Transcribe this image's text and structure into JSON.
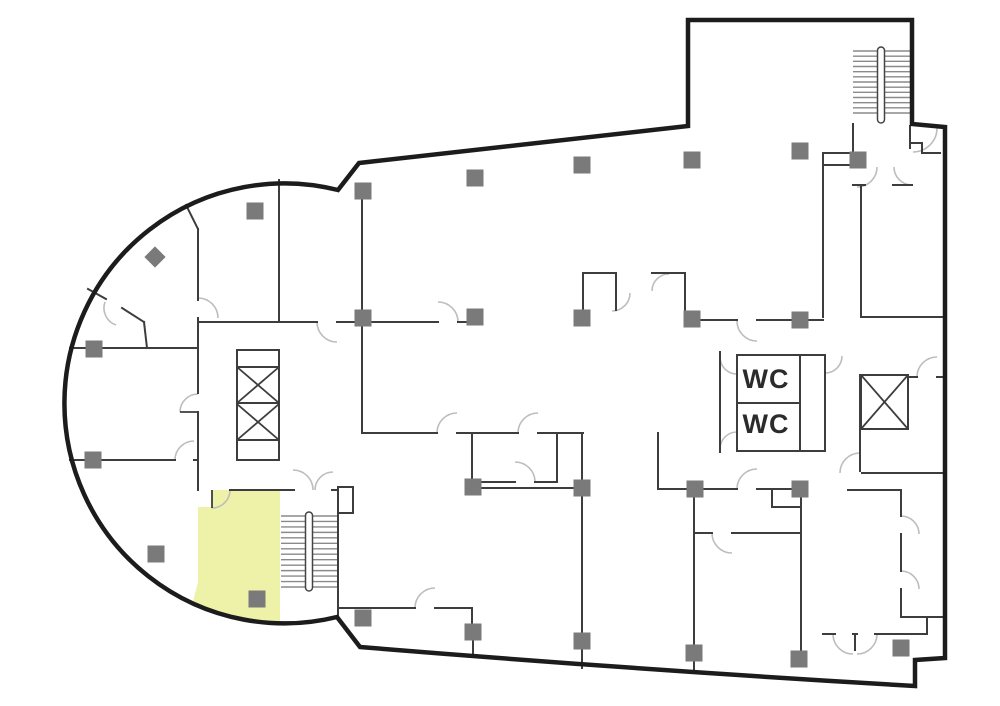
{
  "floor_plan": {
    "canvas": {
      "width": 1000,
      "height": 706
    },
    "labels": {
      "wc_top": "WC",
      "wc_bottom": "WC"
    },
    "colors": {
      "background": "#ffffff",
      "outline": "#1c1c1c",
      "wall": "#3d3d3d",
      "door_arc": "#bdbdbd",
      "column": "#7a7a7a",
      "highlight": "#eef2a8",
      "stair_tread": "#8a8a8a",
      "rail_stroke": "#444444",
      "label_text": "#2b2b2b"
    },
    "outline_path": "M359,163 L688,126 L688,20 L912,20 L912,124 L945,127 L945,658 L915,660 L915,686 Q640,670 360,647 L337,617 A220,220 0 1 1 338,190 Z",
    "highlight_room": {
      "path": "M198,490 L280,490 L280,623 A220,220 0 0 1 192,605 L198,582 Z",
      "door_notch": [
        198,
        490,
        14,
        17
      ]
    },
    "walls": [
      [
        186,
        205,
        198,
        229
      ],
      [
        198,
        229,
        198,
        300
      ],
      [
        198,
        318,
        198,
        393
      ],
      [
        198,
        412,
        198,
        490
      ],
      [
        88,
        289,
        106,
        299
      ],
      [
        122,
        308,
        144,
        322
      ],
      [
        144,
        322,
        147,
        348
      ],
      [
        70,
        348,
        198,
        348
      ],
      [
        70,
        460,
        175,
        460
      ],
      [
        194,
        460,
        198,
        460
      ],
      [
        279,
        180,
        279,
        322
      ],
      [
        362,
        190,
        362,
        433
      ],
      [
        583,
        273,
        583,
        322
      ],
      [
        616,
        273,
        616,
        310
      ],
      [
        685,
        273,
        685,
        320
      ],
      [
        583,
        273,
        616,
        273
      ],
      [
        652,
        273,
        685,
        273
      ],
      [
        198,
        322,
        317,
        322
      ],
      [
        337,
        322,
        438,
        322
      ],
      [
        458,
        322,
        476,
        322
      ],
      [
        685,
        320,
        737,
        320
      ],
      [
        757,
        320,
        823,
        320
      ],
      [
        362,
        433,
        437,
        433
      ],
      [
        457,
        433,
        518,
        433
      ],
      [
        538,
        433,
        583,
        433
      ],
      [
        472,
        433,
        472,
        486
      ],
      [
        557,
        433,
        557,
        482
      ],
      [
        472,
        482,
        515,
        482
      ],
      [
        535,
        482,
        557,
        482
      ],
      [
        582,
        435,
        582,
        638
      ],
      [
        582,
        645,
        582,
        668
      ],
      [
        694,
        489,
        694,
        650
      ],
      [
        694,
        656,
        694,
        672
      ],
      [
        801,
        489,
        801,
        658
      ],
      [
        772,
        489,
        772,
        507
      ],
      [
        772,
        507,
        801,
        507
      ],
      [
        658,
        433,
        658,
        489
      ],
      [
        473,
        488,
        576,
        488
      ],
      [
        658,
        489,
        737,
        489
      ],
      [
        757,
        489,
        801,
        489
      ],
      [
        848,
        490,
        901,
        490
      ],
      [
        694,
        533,
        712,
        533
      ],
      [
        732,
        533,
        801,
        533
      ],
      [
        339,
        608,
        415,
        608
      ],
      [
        435,
        608,
        472,
        608
      ],
      [
        472,
        608,
        472,
        628
      ],
      [
        473,
        636,
        473,
        653
      ],
      [
        823,
        153,
        823,
        317
      ],
      [
        861,
        185,
        861,
        317
      ],
      [
        823,
        153,
        851,
        153
      ],
      [
        823,
        165,
        851,
        165
      ],
      [
        853,
        124,
        853,
        152
      ],
      [
        853,
        185,
        865,
        185
      ],
      [
        893,
        185,
        912,
        185
      ],
      [
        910,
        126,
        910,
        148
      ],
      [
        910,
        143,
        922,
        143
      ],
      [
        922,
        143,
        922,
        153
      ],
      [
        922,
        153,
        940,
        153
      ],
      [
        862,
        317,
        943,
        317
      ],
      [
        860,
        375,
        860,
        471
      ],
      [
        862,
        473,
        943,
        473
      ],
      [
        901,
        490,
        901,
        516
      ],
      [
        901,
        534,
        901,
        571
      ],
      [
        901,
        589,
        901,
        617
      ],
      [
        901,
        617,
        943,
        617
      ],
      [
        908,
        377,
        917,
        377
      ],
      [
        937,
        377,
        943,
        377
      ],
      [
        823,
        634,
        835,
        634
      ],
      [
        853,
        634,
        857,
        634
      ],
      [
        875,
        634,
        927,
        634
      ],
      [
        927,
        617,
        927,
        634
      ],
      [
        855,
        634,
        855,
        650
      ],
      [
        720,
        352,
        720,
        452
      ],
      [
        280,
        490,
        294,
        490
      ],
      [
        332,
        490,
        338,
        490
      ],
      [
        338,
        490,
        338,
        617
      ],
      [
        230,
        490,
        280,
        490
      ],
      [
        800,
        355,
        800,
        451
      ],
      [
        737,
        403,
        800,
        403
      ],
      [
        237,
        367,
        279,
        367
      ],
      [
        237,
        403,
        279,
        403
      ],
      [
        237,
        440,
        279,
        440
      ]
    ],
    "boxes": [
      [
        737,
        355,
        88,
        96
      ],
      [
        237,
        350,
        42,
        110
      ],
      [
        861,
        375,
        47,
        54
      ],
      [
        338,
        487,
        15,
        26
      ]
    ],
    "cross_lines": [
      [
        237,
        367,
        279,
        403
      ],
      [
        279,
        367,
        237,
        403
      ],
      [
        237,
        404,
        279,
        440
      ],
      [
        279,
        404,
        237,
        440
      ],
      [
        861,
        375,
        908,
        429
      ],
      [
        908,
        375,
        861,
        429
      ]
    ],
    "door_arcs": [
      "M198,298 A20,20 0 0 1 218,318",
      "M317,322 A20,20 0 0 0 337,342",
      "M438,302 A20,20 0 0 1 458,322",
      "M437,433 A20,20 0 0 1 457,413",
      "M518,433 A20,20 0 0 1 538,413",
      "M737,321 A20,20 0 0 0 757,341",
      "M737,489 A20,20 0 0 1 757,469",
      "M712,533 A20,20 0 0 0 732,553",
      "M212,508 A18,18 0 0 0 230,490",
      "M175,460 A19,19 0 0 1 194,441",
      "M180,412 A18,18 0 0 1 198,394",
      "M105,302 A18,18 0 0 0 116,325",
      "M313,490 A20,20 0 0 0 293,470",
      "M315,490 A18,18 0 0 1 333,472",
      "M720,357 A17,17 0 0 0 737,374",
      "M720,449 A17,17 0 0 1 737,432",
      "M825,373 A17,17 0 0 0 842,356",
      "M840,473 A20,20 0 0 1 860,453",
      "M901,516 A18,18 0 0 1 919,534",
      "M901,571 A18,18 0 0 1 919,589",
      "M877,167 A20,20 0 0 1 857,187",
      "M894,167 A18,18 0 0 0 912,185",
      "M937,128 A24,24 0 0 1 913,152",
      "M630,293 A18,18 0 0 1 612,311",
      "M652,291 A17,17 0 0 1 669,274",
      "M917,377 A20,20 0 0 1 937,357",
      "M833,634 A20,20 0 0 0 853,654",
      "M877,634 A20,20 0 0 1 857,654",
      "M535,482 A20,20 0 0 0 515,462",
      "M415,608 A20,20 0 0 1 435,588"
    ],
    "door_leaves": [
      [
        212,
        490,
        212,
        508
      ],
      [
        180,
        412,
        198,
        412
      ]
    ],
    "stairs": [
      {
        "x1": 853,
        "x2": 910,
        "y_start": 51,
        "y_end": 113,
        "treads": 13,
        "rail": [
          877.5,
          47,
          7,
          76
        ]
      },
      {
        "x1": 281,
        "x2": 337,
        "y_start": 516,
        "y_end": 587,
        "treads": 14,
        "rail": [
          305.5,
          512,
          7,
          79
        ]
      }
    ],
    "columns": [
      [
        255,
        211
      ],
      [
        363,
        191
      ],
      [
        475,
        178
      ],
      [
        582,
        165
      ],
      [
        692,
        160
      ],
      [
        800,
        151
      ],
      [
        858,
        160
      ],
      [
        363,
        318
      ],
      [
        475,
        317
      ],
      [
        582,
        318
      ],
      [
        692,
        319
      ],
      [
        800,
        320
      ],
      [
        94,
        349
      ],
      [
        93,
        460
      ],
      [
        156,
        554
      ],
      [
        473,
        487
      ],
      [
        582,
        488
      ],
      [
        695,
        489
      ],
      [
        800,
        489
      ],
      [
        257,
        599
      ],
      [
        363,
        618
      ],
      [
        473,
        632
      ],
      [
        582,
        641
      ],
      [
        694,
        653
      ],
      [
        799,
        659
      ],
      [
        901,
        648
      ]
    ],
    "column_size": 17,
    "diamond_column": [
      155,
      257
    ],
    "wc": {
      "label_positions": [
        [
          766,
          381
        ],
        [
          766,
          426
        ]
      ]
    }
  }
}
